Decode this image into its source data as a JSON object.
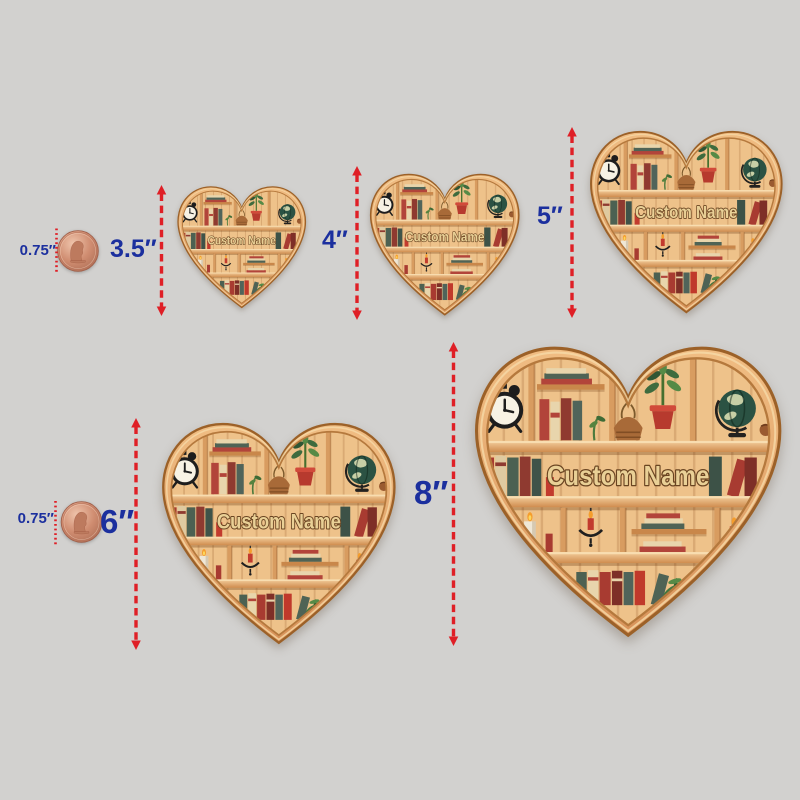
{
  "colors": {
    "background": "#d2d1cf",
    "label_blue": "#1b2f9e",
    "arrow_red": "#df1f26",
    "wood_frame": "#e2a367",
    "wood_panel": "#eec28a"
  },
  "ornament": {
    "name_text": "Custom Name"
  },
  "reference_coins": [
    {
      "label": "0.75″"
    },
    {
      "label": "0.75″"
    }
  ],
  "size_variants": [
    {
      "label": "3.5″"
    },
    {
      "label": "4″"
    },
    {
      "label": "5″"
    },
    {
      "label": "6″"
    },
    {
      "label": "8″"
    }
  ]
}
